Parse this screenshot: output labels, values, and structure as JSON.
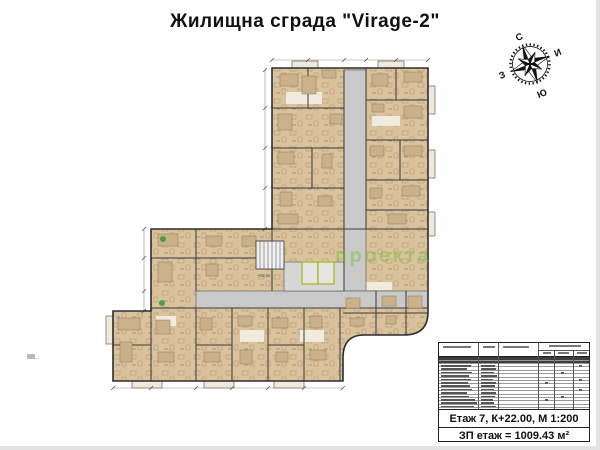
{
  "title": "Жилищна сграда \"Virage-2\"",
  "compass": {
    "north": "С",
    "east": "И",
    "south": "Ю",
    "west": "З",
    "rotation_deg": -22
  },
  "watermark": {
    "text": "проекта",
    "color": "#7fbf3f",
    "opacity": 0.5
  },
  "plan": {
    "outline_path": "M272,68 H428 V312 Q428,335 404,335 H364 Q343,335 343,358 V381 H113 V311 H151 V229 H272 Z",
    "fill_color": "#d9c29c",
    "wall_color": "#3a3a3a",
    "corridor_color": "#c9c9c9",
    "lobby_color": "#d6d6d6",
    "elevator_outline_color": "#aebd2b",
    "level_label": "+22.00",
    "corridors": [
      [
        344,
        70,
        22,
        221
      ],
      [
        196,
        291,
        232,
        17
      ]
    ],
    "lobby": [
      284,
      262,
      60,
      29
    ],
    "stair": {
      "x": 256,
      "y": 241,
      "w": 28,
      "h": 28,
      "steps": 7
    },
    "elevators": [
      [
        302,
        262,
        16,
        22
      ],
      [
        318,
        262,
        16,
        22
      ]
    ],
    "walls": [
      [
        272,
        108,
        344,
        108
      ],
      [
        272,
        148,
        344,
        148
      ],
      [
        272,
        188,
        344,
        188
      ],
      [
        366,
        100,
        428,
        100
      ],
      [
        366,
        140,
        428,
        140
      ],
      [
        366,
        180,
        428,
        180
      ],
      [
        366,
        210,
        428,
        210
      ],
      [
        344,
        70,
        344,
        291
      ],
      [
        366,
        68,
        366,
        229
      ],
      [
        272,
        229,
        428,
        229
      ],
      [
        151,
        258,
        272,
        258
      ],
      [
        196,
        229,
        196,
        291
      ],
      [
        272,
        229,
        272,
        291
      ],
      [
        308,
        68,
        308,
        108
      ],
      [
        312,
        148,
        312,
        188
      ],
      [
        396,
        68,
        396,
        100
      ],
      [
        400,
        140,
        400,
        180
      ],
      [
        151,
        308,
        428,
        308
      ],
      [
        151,
        311,
        151,
        381
      ],
      [
        196,
        308,
        196,
        381
      ],
      [
        232,
        308,
        232,
        381
      ],
      [
        268,
        308,
        268,
        381
      ],
      [
        304,
        308,
        304,
        381
      ],
      [
        340,
        308,
        340,
        381
      ],
      [
        376,
        291,
        376,
        335
      ],
      [
        406,
        291,
        406,
        335
      ],
      [
        343,
        313,
        428,
        313
      ],
      [
        113,
        345,
        151,
        345
      ],
      [
        196,
        345,
        232,
        345
      ],
      [
        268,
        345,
        304,
        345
      ]
    ],
    "furniture": [
      [
        280,
        74,
        18,
        12
      ],
      [
        302,
        76,
        14,
        18
      ],
      [
        322,
        70,
        14,
        8
      ],
      [
        372,
        74,
        16,
        12
      ],
      [
        404,
        72,
        18,
        10
      ],
      [
        278,
        114,
        14,
        16
      ],
      [
        330,
        114,
        12,
        10
      ],
      [
        404,
        106,
        18,
        12
      ],
      [
        372,
        104,
        12,
        8
      ],
      [
        278,
        152,
        16,
        12
      ],
      [
        322,
        154,
        10,
        14
      ],
      [
        404,
        146,
        18,
        10
      ],
      [
        370,
        146,
        14,
        10
      ],
      [
        280,
        192,
        12,
        14
      ],
      [
        318,
        196,
        14,
        10
      ],
      [
        402,
        186,
        18,
        10
      ],
      [
        370,
        188,
        12,
        10
      ],
      [
        278,
        214,
        20,
        10
      ],
      [
        388,
        214,
        18,
        10
      ],
      [
        158,
        234,
        20,
        12
      ],
      [
        158,
        262,
        14,
        20
      ],
      [
        206,
        236,
        16,
        10
      ],
      [
        242,
        236,
        14,
        10
      ],
      [
        206,
        264,
        12,
        12
      ],
      [
        118,
        318,
        22,
        12
      ],
      [
        120,
        342,
        12,
        20
      ],
      [
        156,
        320,
        14,
        14
      ],
      [
        158,
        352,
        16,
        10
      ],
      [
        200,
        318,
        12,
        12
      ],
      [
        204,
        352,
        16,
        10
      ],
      [
        238,
        316,
        14,
        10
      ],
      [
        240,
        350,
        12,
        14
      ],
      [
        272,
        318,
        16,
        10
      ],
      [
        276,
        352,
        12,
        10
      ],
      [
        310,
        316,
        12,
        12
      ],
      [
        310,
        350,
        16,
        10
      ],
      [
        346,
        298,
        14,
        10
      ],
      [
        350,
        318,
        14,
        8
      ],
      [
        382,
        296,
        14,
        10
      ],
      [
        386,
        316,
        10,
        8
      ],
      [
        408,
        296,
        14,
        12
      ]
    ],
    "whiteouts": [
      [
        286,
        92,
        36,
        12
      ],
      [
        372,
        116,
        28,
        10
      ],
      [
        156,
        316,
        20,
        10
      ],
      [
        352,
        282,
        40,
        8
      ],
      [
        240,
        330,
        24,
        12
      ],
      [
        300,
        330,
        24,
        12
      ]
    ],
    "balconies": [
      [
        292,
        61,
        26,
        7
      ],
      [
        378,
        61,
        26,
        7
      ],
      [
        428,
        86,
        7,
        28
      ],
      [
        428,
        150,
        7,
        28
      ],
      [
        428,
        212,
        7,
        24
      ],
      [
        132,
        381,
        30,
        7
      ],
      [
        204,
        381,
        30,
        7
      ],
      [
        274,
        381,
        30,
        7
      ],
      [
        106,
        316,
        7,
        28
      ]
    ],
    "plants": [
      [
        163,
        239
      ],
      [
        162,
        303
      ]
    ],
    "dims": [
      {
        "line": [
          265,
          70,
          265,
          229
        ],
        "ticks": [
          [
            265,
            70
          ],
          [
            265,
            108
          ],
          [
            265,
            148
          ],
          [
            265,
            188
          ],
          [
            265,
            229
          ]
        ]
      },
      {
        "line": [
          144,
          229,
          144,
          311
        ],
        "ticks": [
          [
            144,
            229
          ],
          [
            144,
            258
          ],
          [
            144,
            291
          ],
          [
            144,
            311
          ]
        ]
      },
      {
        "line": [
          113,
          388,
          343,
          388
        ],
        "ticks": [
          [
            113,
            388
          ],
          [
            151,
            388
          ],
          [
            196,
            388
          ],
          [
            232,
            388
          ],
          [
            268,
            388
          ],
          [
            304,
            388
          ],
          [
            343,
            388
          ]
        ]
      },
      {
        "line": [
          272,
          60,
          428,
          60
        ],
        "ticks": [
          [
            272,
            60
          ],
          [
            308,
            60
          ],
          [
            344,
            60
          ],
          [
            366,
            60
          ],
          [
            396,
            60
          ],
          [
            428,
            60
          ]
        ]
      }
    ]
  },
  "legend_table": {
    "col_lines_full": [
      39,
      59,
      99
    ],
    "col_lines_sub": [
      115,
      134
    ],
    "header_bars": [
      [
        4,
        3,
        28
      ],
      [
        44,
        3,
        12
      ],
      [
        64,
        3,
        26
      ],
      [
        104,
        9,
        8
      ],
      [
        119,
        9,
        11
      ],
      [
        138,
        9,
        10
      ],
      [
        110,
        2,
        32
      ]
    ],
    "rows": [
      {
        "dark": true,
        "h": 4
      },
      {
        "dark": true,
        "h": 3
      },
      {
        "dark": false,
        "h": 3.4,
        "b1": 30,
        "b2": 14,
        "r": 3
      },
      {
        "dark": false,
        "h": 3.4,
        "b1": 26,
        "b2": 15,
        "r": 0
      },
      {
        "dark": false,
        "h": 3.4,
        "b1": 31,
        "b2": 13,
        "r": 2
      },
      {
        "dark": false,
        "h": 3.4,
        "b1": 28,
        "b2": 16,
        "r": 0
      },
      {
        "dark": false,
        "h": 3.4,
        "b1": 30,
        "b2": 12,
        "r": 3
      },
      {
        "dark": false,
        "h": 3.4,
        "b1": 27,
        "b2": 15,
        "r": 1
      },
      {
        "dark": false,
        "h": 3.4,
        "b1": 29,
        "b2": 14,
        "r": 0
      },
      {
        "dark": false,
        "h": 3.4,
        "b1": 31,
        "b2": 13,
        "r": 3
      },
      {
        "dark": false,
        "h": 3.4,
        "b1": 26,
        "b2": 15,
        "r": 0
      },
      {
        "dark": false,
        "h": 3.4,
        "b1": 28,
        "b2": 14,
        "r": 2
      },
      {
        "dark": false,
        "h": 3.4,
        "b1": 34,
        "b2": 12,
        "r": 1
      },
      {
        "dark": false,
        "h": 3.4,
        "b1": 36,
        "b2": 13,
        "r": 0
      },
      {
        "dark": false,
        "h": 3.4,
        "b1": 33,
        "b2": 15,
        "r": 0
      }
    ],
    "footer_line1": "Етаж 7, К+22.00, М 1:200",
    "footer_line2": "ЗП етаж = 1009.43 м²"
  }
}
